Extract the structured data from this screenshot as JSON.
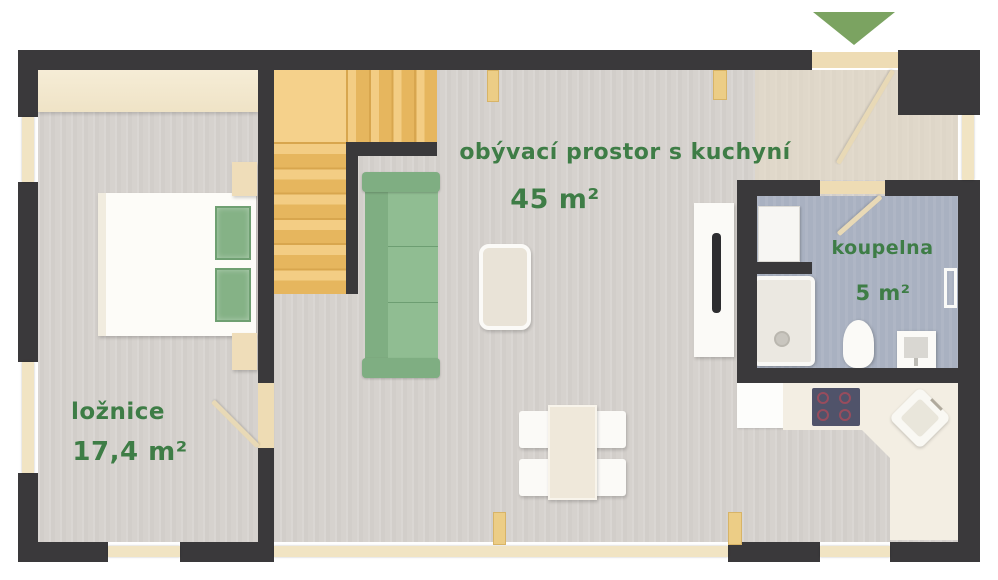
{
  "plan": {
    "rooms": [
      {
        "label": "ložnice",
        "area": "17,4 m²"
      },
      {
        "label": "obývací prostor s kuchyní",
        "area": "45 m²"
      },
      {
        "label": "koupelna",
        "area": "5 m²"
      }
    ],
    "entrance": {
      "icon": "entrance-arrow-icon",
      "direction": "down"
    },
    "colors": {
      "wall": "#3a393b",
      "label_green": "#3e7d46",
      "arrow_green": "#7ba361",
      "stair_wood": "#f2ca7e",
      "floor_gray": "#d6d2ce",
      "bathroom_floor": "#a9b1c1",
      "sofa_green": "#86b388",
      "window_wood": "#f1e4c3"
    },
    "furniture": [
      "wardrobe",
      "bed",
      "pillows",
      "nightstands",
      "stairs",
      "sofa",
      "coffee-table",
      "tv",
      "dining-table",
      "chairs",
      "fridge",
      "kitchen-counter",
      "cooktop",
      "kitchen-sink",
      "washing-machine",
      "shower",
      "toilet",
      "bathroom-sink",
      "towel-radiator"
    ]
  }
}
